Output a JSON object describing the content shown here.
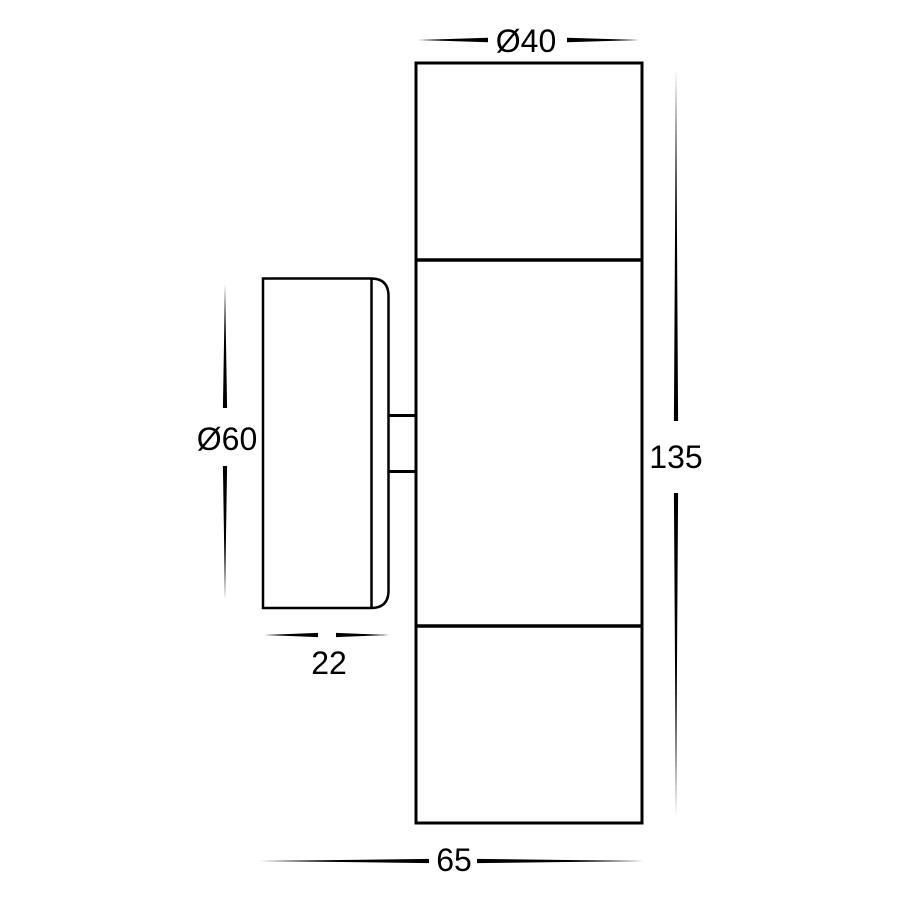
{
  "drawing": {
    "colors": {
      "line": "#000000",
      "background": "#ffffff"
    },
    "labels": {
      "body_diameter": "Ø40",
      "plate_diameter": "Ø60",
      "body_height": "135",
      "plate_depth": "22",
      "overall_depth": "65"
    }
  }
}
